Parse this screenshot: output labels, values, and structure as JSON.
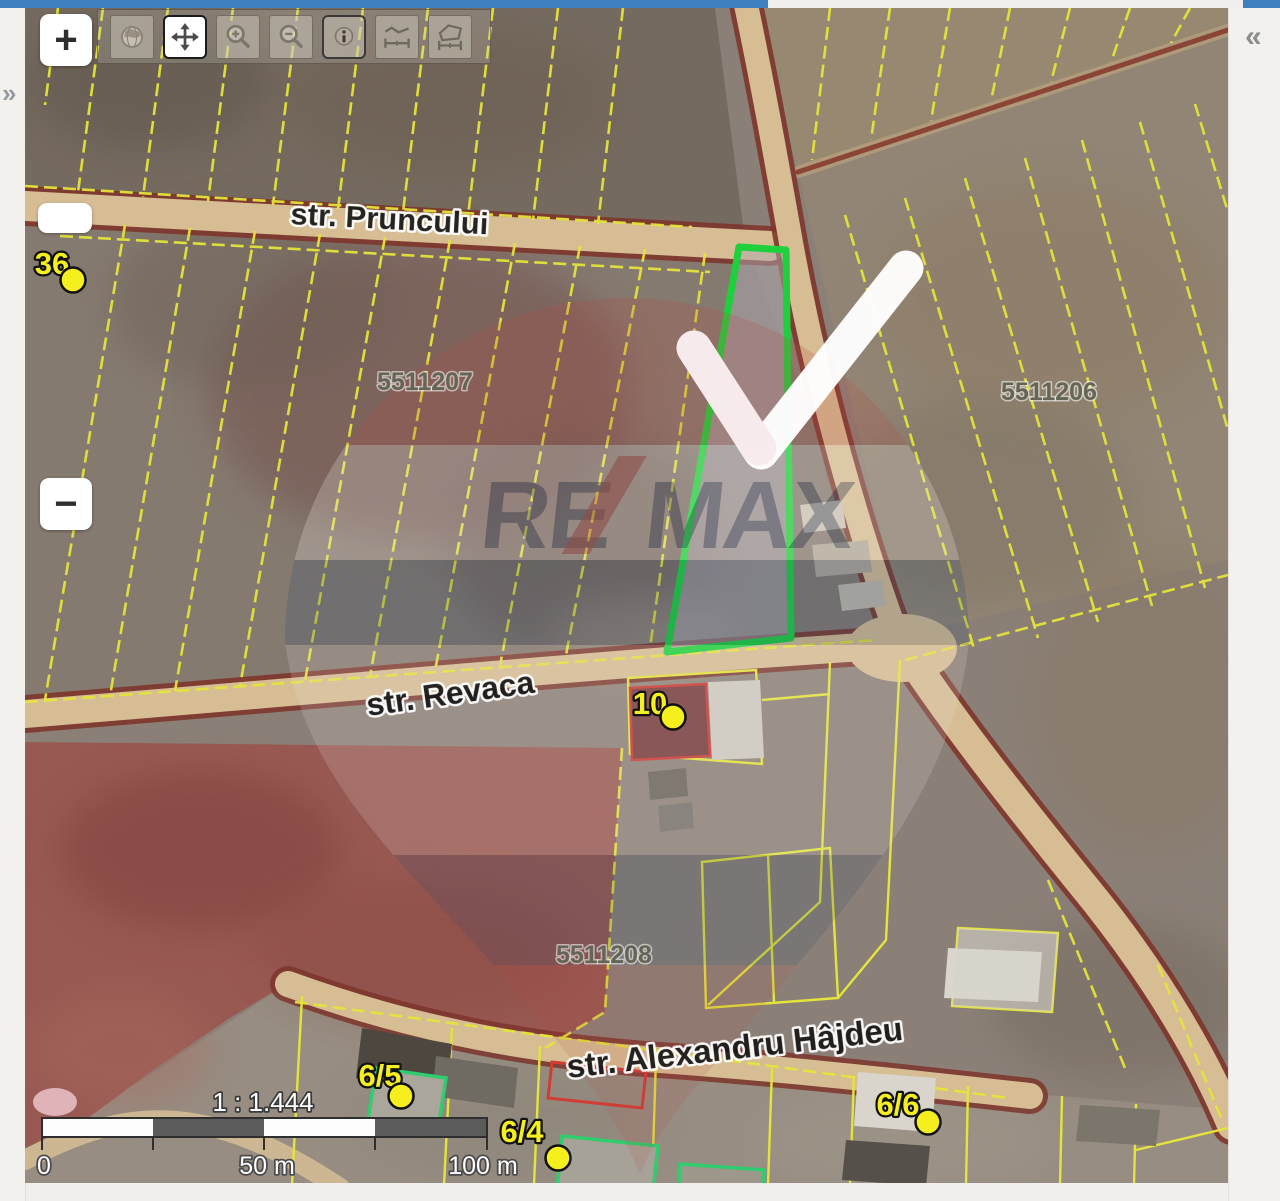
{
  "app": {
    "description": "cadastral web map viewer with satellite imagery"
  },
  "panels": {
    "left_toggle": "»",
    "right_toggle": "«"
  },
  "controls": {
    "zoom_in": "+",
    "zoom_out": "−"
  },
  "toolbar": {
    "tools": [
      "zoom-to-extent",
      "pan",
      "zoom-in",
      "zoom-out",
      "identify",
      "measure-distance",
      "measure-area"
    ],
    "active_tool": "pan"
  },
  "map": {
    "streets": [
      "str. Pruncului",
      "str. Revaca",
      "str. Alexandru Hâjdeu"
    ],
    "parcels": [
      "5511207",
      "5511206",
      "5511208"
    ],
    "houses": [
      "36",
      "10",
      "6/5",
      "6/4",
      "6/6"
    ],
    "watermark": {
      "brand_left": "RE",
      "brand_right": "MAX"
    },
    "highlight_color": "#1ed13c",
    "parcel_line_color": "#e4e43a",
    "road_fill_color": "#d7bd94",
    "road_edge_color": "#7d352b",
    "scale": {
      "ratio": "1 : 1.444",
      "t0": "0",
      "t50": "50 m",
      "t100": "100 m"
    }
  },
  "colors": {
    "top_bar": "#3e7fbe",
    "panel": "#f2f1ee",
    "marker_dot": "#f4ef1d"
  }
}
